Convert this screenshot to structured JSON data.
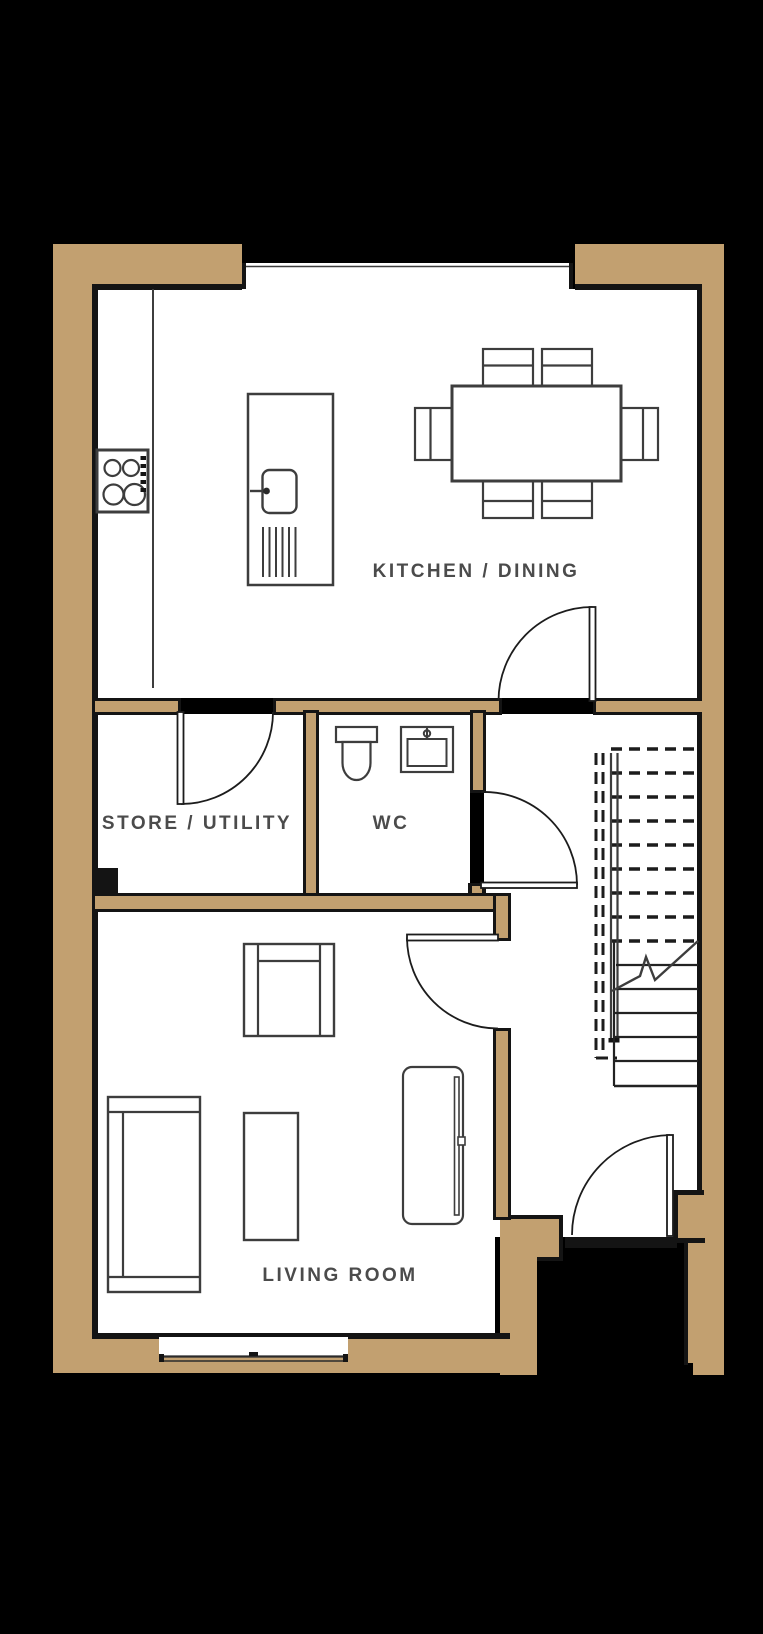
{
  "colors": {
    "background": "#000000",
    "wall_fill": "#C2A070",
    "wall_line": "#141414",
    "floor": "#ffffff",
    "furniture_line": "#3d3d3d",
    "label_text": "#4b4b4b"
  },
  "rooms": {
    "kitchen_dining": "KITCHEN / DINING",
    "store_utility": "STORE / UTILITY",
    "wc": "WC",
    "living_room": "LIVING ROOM"
  },
  "fixtures": [
    "hob",
    "kitchen-island-with-sink-and-drainer",
    "dining-table-with-six-chairs",
    "toilet",
    "basin",
    "staircase-with-break-line",
    "armchair",
    "sofa",
    "coffee-table",
    "tv-unit"
  ],
  "doors": [
    "store-utility-door",
    "kitchen-door",
    "wc-door",
    "living-room-door",
    "front-entrance-door"
  ],
  "windows": [
    "kitchen-top-window",
    "living-room-bottom-window"
  ],
  "stairs": {
    "dashed_treads": 9,
    "solid_treads": 5,
    "break_line": "zigzag"
  }
}
